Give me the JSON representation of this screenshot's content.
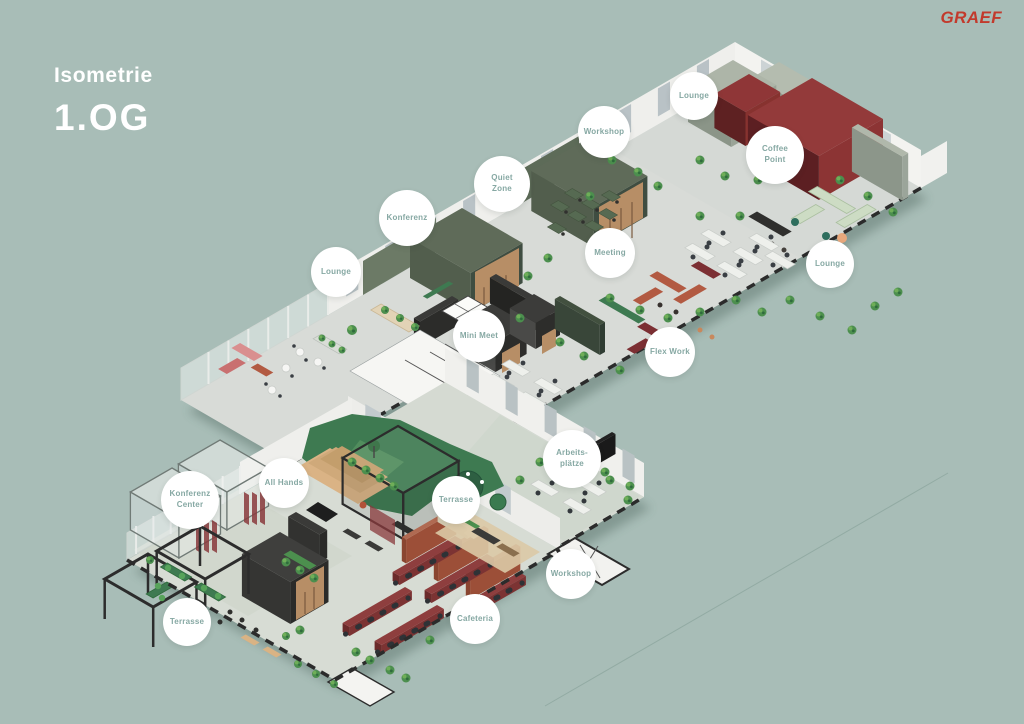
{
  "page": {
    "title_line1": "Isometrie",
    "title_line2": "1.OG",
    "logo": "GRAEF"
  },
  "palette": {
    "background": "#a8bdb7",
    "floor": "#d8dbd7",
    "wall": "#efefec",
    "maroon": "#8c3434",
    "maroon_dark": "#5c1f22",
    "room_green": "#5f6b59",
    "room_green_dark": "#3f4d41",
    "sage": "#9aa497",
    "forest_green": "#3e7a51",
    "wood": "#b78e66",
    "charcoal": "#2e2e2e",
    "celadon": "#cddcc4",
    "terracotta": "#b25a42",
    "label_text": "#86a8a3",
    "logo_red": "#c23a2c",
    "facade_dark": "#2b2b2b"
  },
  "labels": [
    {
      "id": "lounge-top",
      "text": "Lounge"
    },
    {
      "id": "workshop-top",
      "text": "Workshop"
    },
    {
      "id": "coffee-point",
      "text": "Coffee\nPoint"
    },
    {
      "id": "quiet-zone",
      "text": "Quiet\nZone"
    },
    {
      "id": "konferenz",
      "text": "Konferenz"
    },
    {
      "id": "meeting",
      "text": "Meeting"
    },
    {
      "id": "lounge-right",
      "text": "Lounge"
    },
    {
      "id": "lounge-left",
      "text": "Lounge"
    },
    {
      "id": "mini-meet",
      "text": "Mini Meet"
    },
    {
      "id": "flex-work",
      "text": "Flex Work"
    },
    {
      "id": "arbeitsplaetze",
      "text": "Arbeits-\nplätze"
    },
    {
      "id": "all-hands",
      "text": "All Hands"
    },
    {
      "id": "terrasse-mid",
      "text": "Terrasse"
    },
    {
      "id": "konferenz-center",
      "text": "Konferenz\nCenter"
    },
    {
      "id": "workshop-bottom",
      "text": "Workshop"
    },
    {
      "id": "cafeteria",
      "text": "Cafeteria"
    },
    {
      "id": "terrasse-bottom",
      "text": "Terrasse"
    }
  ]
}
